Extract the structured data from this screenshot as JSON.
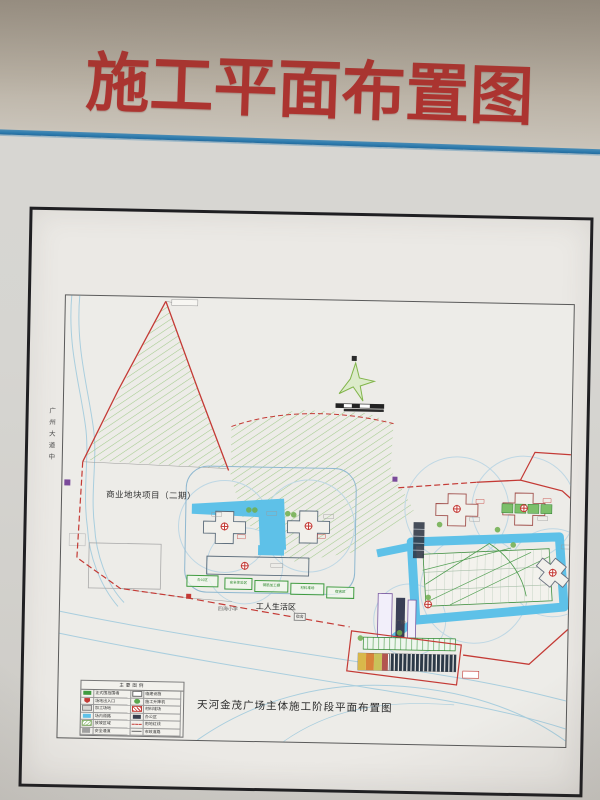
{
  "header": {
    "title": "施工平面布置图"
  },
  "colors": {
    "title_red": "#ac3430",
    "stripe_blue": "#2e7cae",
    "boundary_red": "#c43a35",
    "site_road_cyan": "#5ec1e8",
    "hatch_green": "#9cc784",
    "crane_circle_blue": "#bed7e4",
    "legend_green": "#3f9b3f"
  },
  "drawing": {
    "sheet_title": "天河金茂广场主体施工阶段平面布置图",
    "labels": {
      "commercial_plot": "商业地块项目（二期）",
      "workers_area": "工人生活区",
      "school": "四海小学",
      "square": "广场",
      "dorm_tag": "宿舍",
      "road_vertical": "广州大道中"
    },
    "facilities": [
      "办公区",
      "安全体验区",
      "钢筋加工棚",
      "材料堆场",
      "宿舍区"
    ],
    "legend": {
      "title": "主要图例",
      "rows": [
        {
          "label1": "正式围挡围墙",
          "label2": "临建设施"
        },
        {
          "label1": "场地出入口",
          "label2": "施工升降机"
        },
        {
          "label1": "加工场地",
          "label2": "材料堆场"
        },
        {
          "label1": "场内道路",
          "label2": "办公区"
        },
        {
          "label1": "放坡区域",
          "label2": "用地红线"
        },
        {
          "label1": "安全通道",
          "label2": "市政道路"
        }
      ]
    }
  }
}
